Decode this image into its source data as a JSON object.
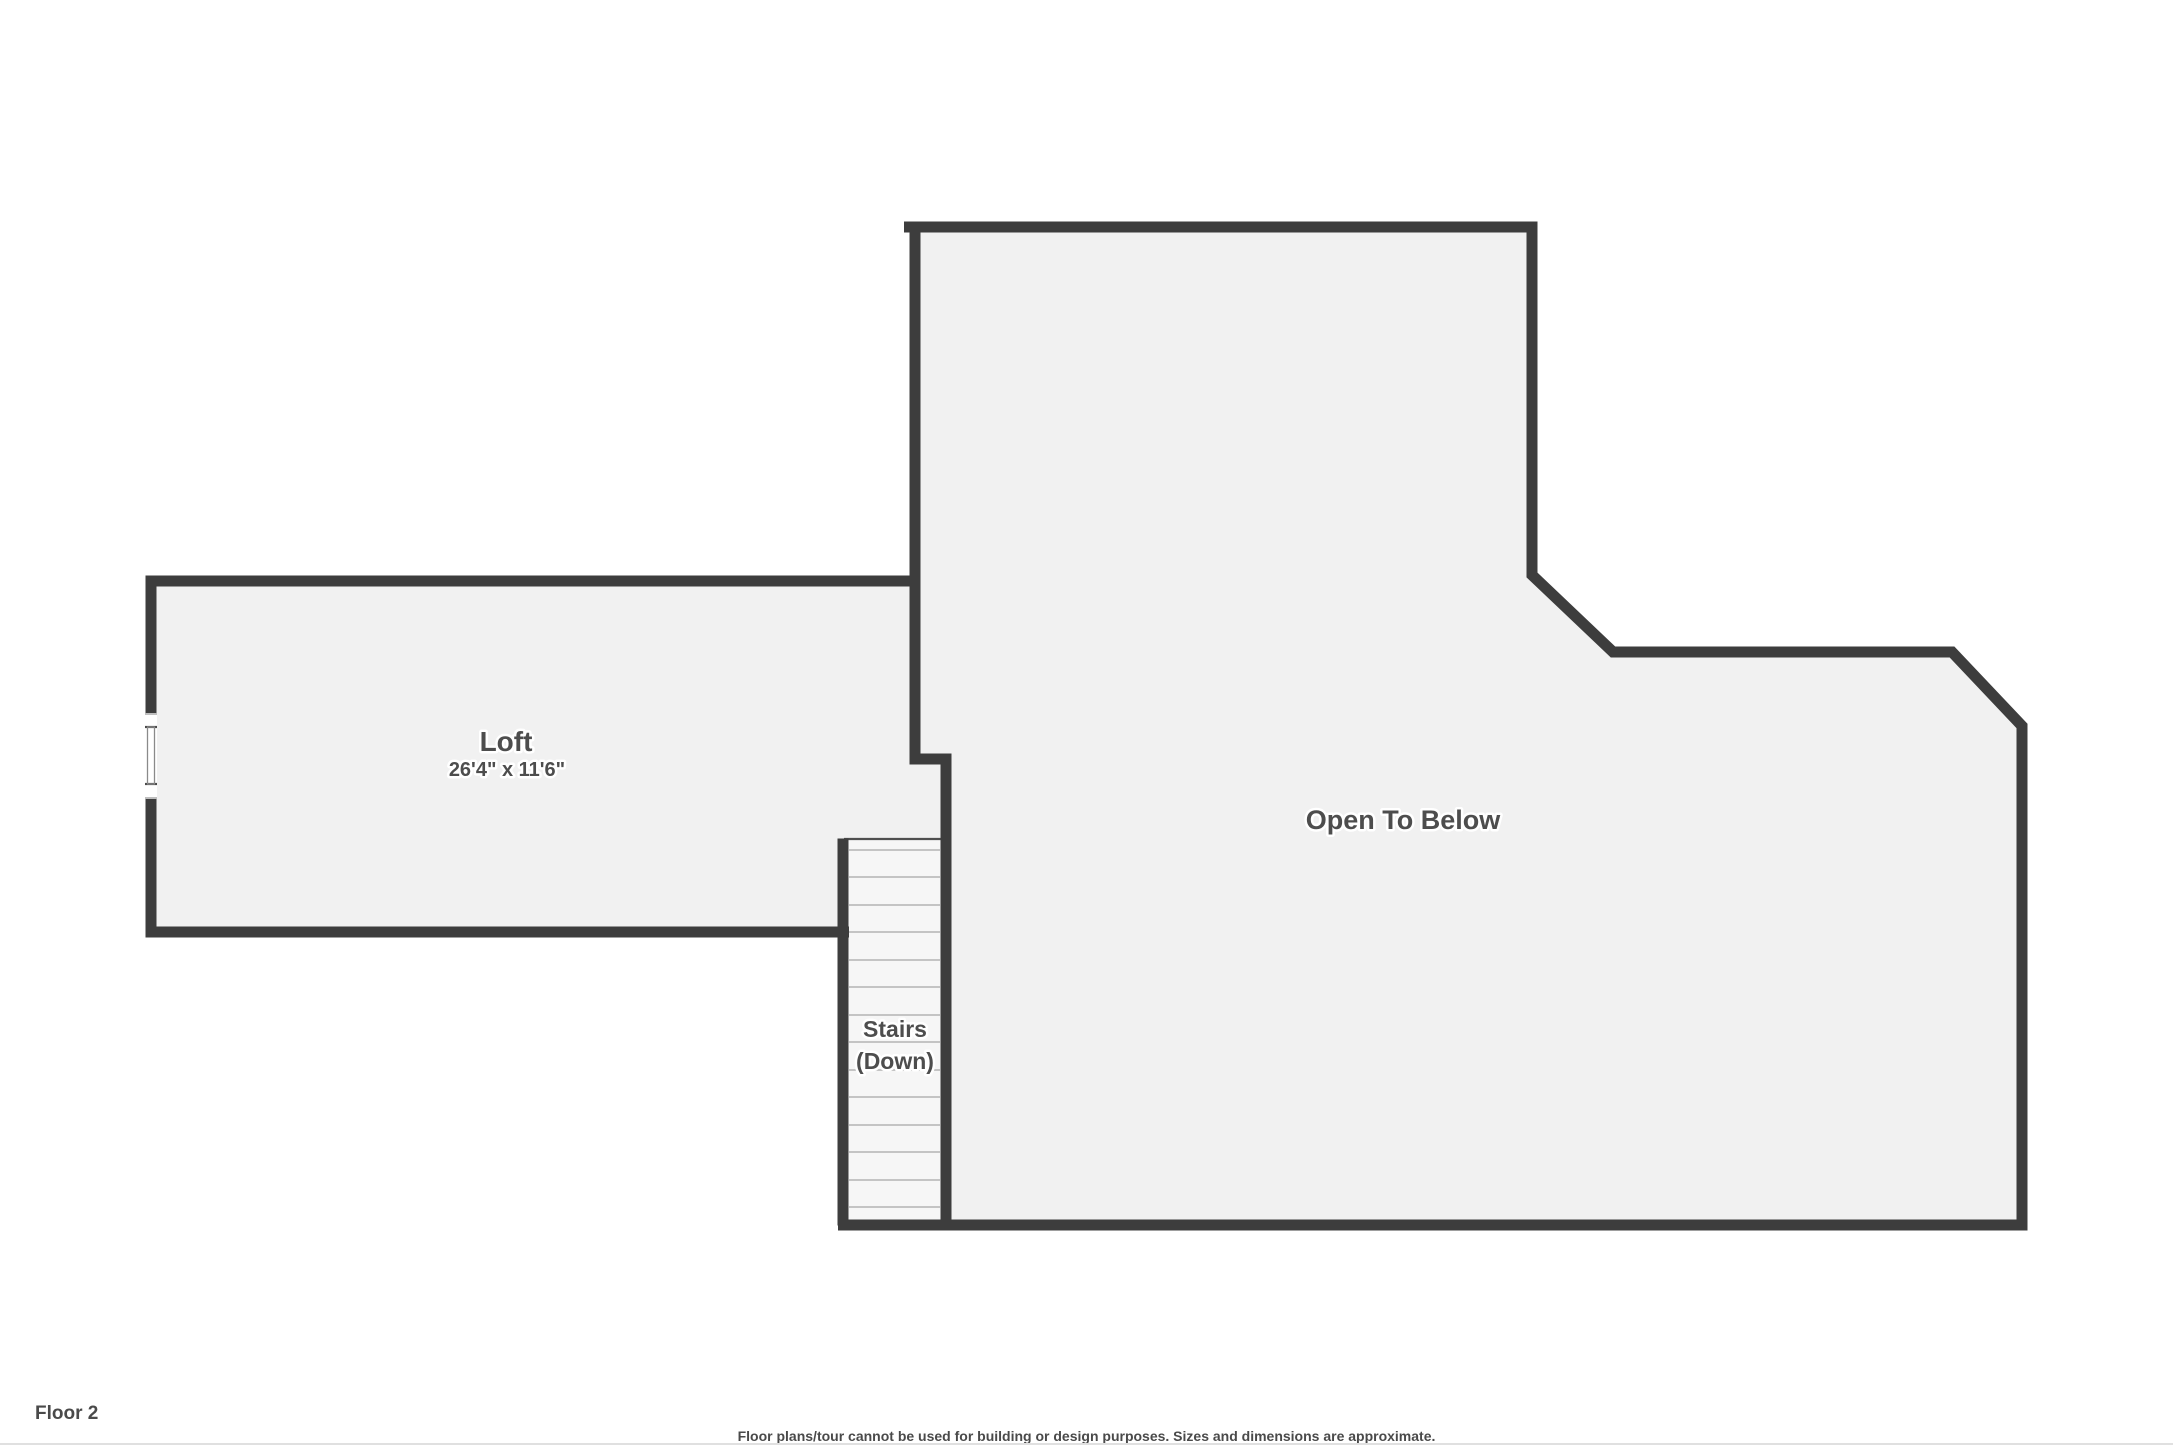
{
  "colors": {
    "wall": "#3d3d3d",
    "floor": "#f1f1f1",
    "stairs_floor": "#f6f6f6",
    "tread": "#b4b4b4",
    "label": "#4d4d4d",
    "footer_text": "#4a4a4a"
  },
  "floorplan": {
    "rooms": {
      "loft": {
        "name": "Loft",
        "dimensions": "26'4\" x 11'6\""
      },
      "open_to_below": {
        "name": "Open To Below"
      },
      "stairs": {
        "line1": "Stairs",
        "line2": "(Down)"
      }
    }
  },
  "footer": {
    "floor_label": "Floor 2",
    "disclaimer": "Floor plans/tour cannot be used for building or design purposes. Sizes and dimensions are approximate."
  }
}
